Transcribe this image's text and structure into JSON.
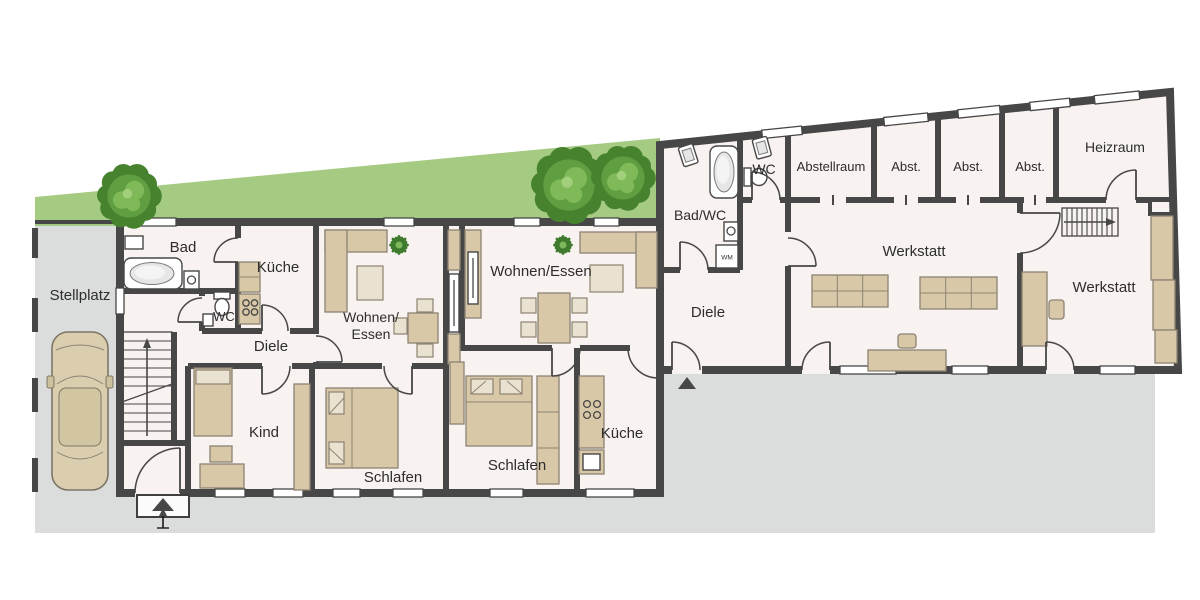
{
  "colors": {
    "wall": "#474747",
    "floor": "#f8f2f0",
    "pavement": "#dbdcdc",
    "garden": "#a5cb83",
    "tree_dark": "#47832f",
    "tree_mid": "#5f9e41",
    "tree_light": "#7fb958",
    "furniture": "#d8c8a7",
    "furniture_light": "#eae2d1",
    "furniture_stroke": "#8c8372",
    "text": "#2d2d2d"
  },
  "rooms": {
    "stellplatz": "Stellplatz",
    "bad": "Bad",
    "kueche_1": "Küche",
    "wc_1": "WC",
    "diele_1": "Diele",
    "wohnen_essen_1_line1": "Wohnen/",
    "wohnen_essen_1_line2": "Essen",
    "kind": "Kind",
    "schlafen_1": "Schlafen",
    "wohnen_essen_2": "Wohnen/Essen",
    "schlafen_2": "Schlafen",
    "kueche_2": "Küche",
    "bad_wc": "Bad/WC",
    "wc_2": "WC",
    "diele_2": "Diele",
    "abstellraum": "Abstellraum",
    "abst_1": "Abst.",
    "abst_2": "Abst.",
    "abst_3": "Abst.",
    "heizraum": "Heizraum",
    "werkstatt_1": "Werkstatt",
    "werkstatt_2": "Werkstatt"
  },
  "fixtures": {
    "washing_machine": "WM"
  }
}
